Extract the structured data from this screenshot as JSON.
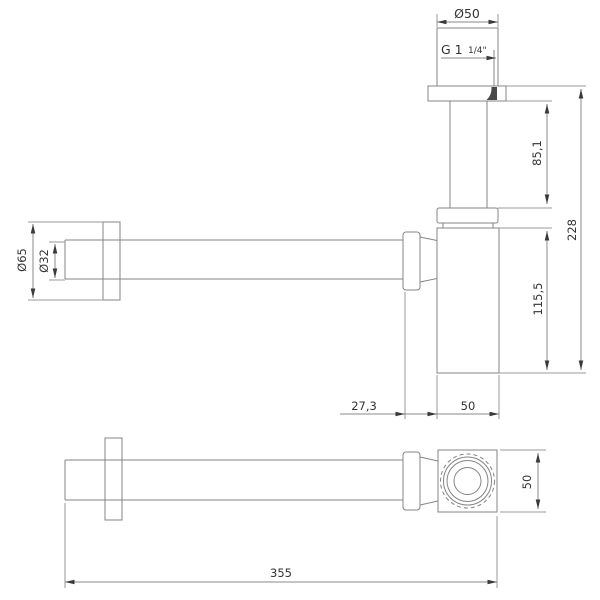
{
  "drawing": {
    "kind": "technical-dimension-drawing",
    "views": [
      "side-elevation",
      "plan"
    ],
    "colors": {
      "background": "#ffffff",
      "geometry_line": "#848484",
      "dimension_line": "#8a8a8a",
      "text": "#333333",
      "arrow": "#3a3a3a",
      "thread_shade": "#4a4a4a"
    },
    "dims": {
      "top_diameter": "Ø50",
      "thread_size": "G 1",
      "thread_fraction": "1/4\"",
      "inlet_tube_length": "85,1",
      "overall_height": "228",
      "body_height": "115,5",
      "wall_flange_diameter": "Ø65",
      "wall_pipe_diameter": "Ø32",
      "inlet_offset": "27,3",
      "body_width": "50",
      "body_depth": "50",
      "overall_length": "355"
    }
  }
}
